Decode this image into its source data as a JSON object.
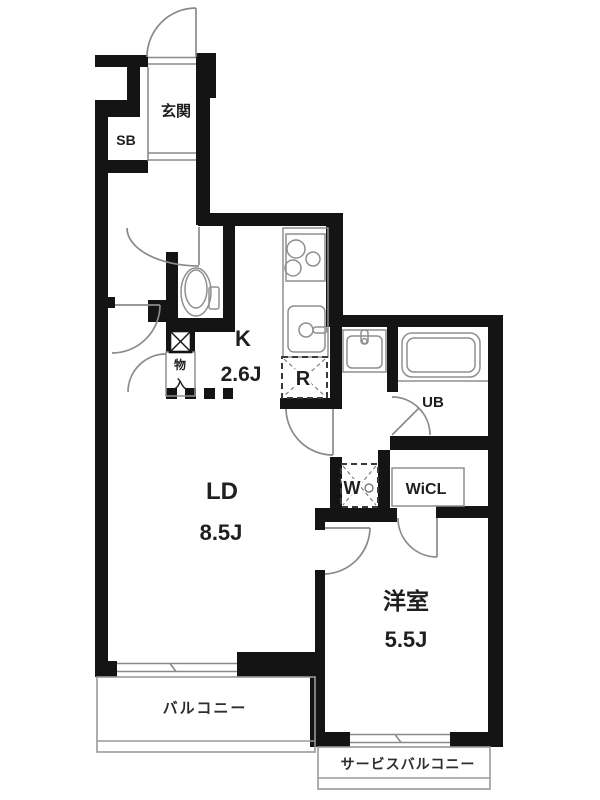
{
  "plan": {
    "type": "japanese-apartment-floorplan",
    "rooms": {
      "entrance": {
        "label": "玄関"
      },
      "shoe_box": {
        "label": "SB"
      },
      "kitchen": {
        "label": "K",
        "size": "2.6J"
      },
      "living_dining": {
        "label": "LD",
        "size": "8.5J"
      },
      "unit_bath": {
        "label": "UB"
      },
      "walk_in_closet": {
        "label": "WiCL"
      },
      "western_room": {
        "label": "洋室",
        "size": "5.5J"
      },
      "balcony": {
        "label": "バルコニー"
      },
      "service_balcony": {
        "label": "サービスバルコニー"
      },
      "storage": {
        "label": "物入",
        "char1": "物",
        "char2": "入"
      },
      "washer_space": {
        "label": "W"
      },
      "refrigerator_space": {
        "label": "R"
      }
    },
    "colors": {
      "wall": "#141414",
      "fixture_line": "#8a8a8a",
      "text": "#1f1f1f",
      "background": "#ffffff"
    }
  }
}
